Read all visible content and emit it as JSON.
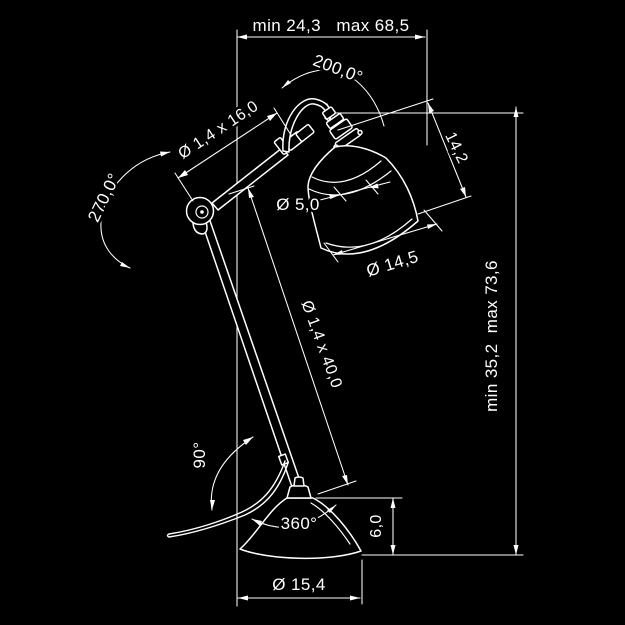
{
  "drawing": {
    "type": "technical-dimension-diagram",
    "subject": "articulated desk lamp",
    "colors": {
      "background": "#000000",
      "line": "#ffffff"
    },
    "dims": {
      "top_width": "min 24,3   max 68,5",
      "head_rotation": "200,0°",
      "upper_rod": "Ø 1,4 x 16,0",
      "elbow_rotation": "270,0°",
      "neck_diameter": "Ø 5,0",
      "shade_height": "14,2",
      "shade_diameter": "Ø 14,5",
      "lower_rod": "Ø 1,4 x 40,0",
      "total_height": "min 35,2  max 73,6",
      "arm_tilt": "90°",
      "base_rotation": "360°",
      "base_height": "6,0",
      "base_diameter": "Ø 15,4"
    }
  }
}
